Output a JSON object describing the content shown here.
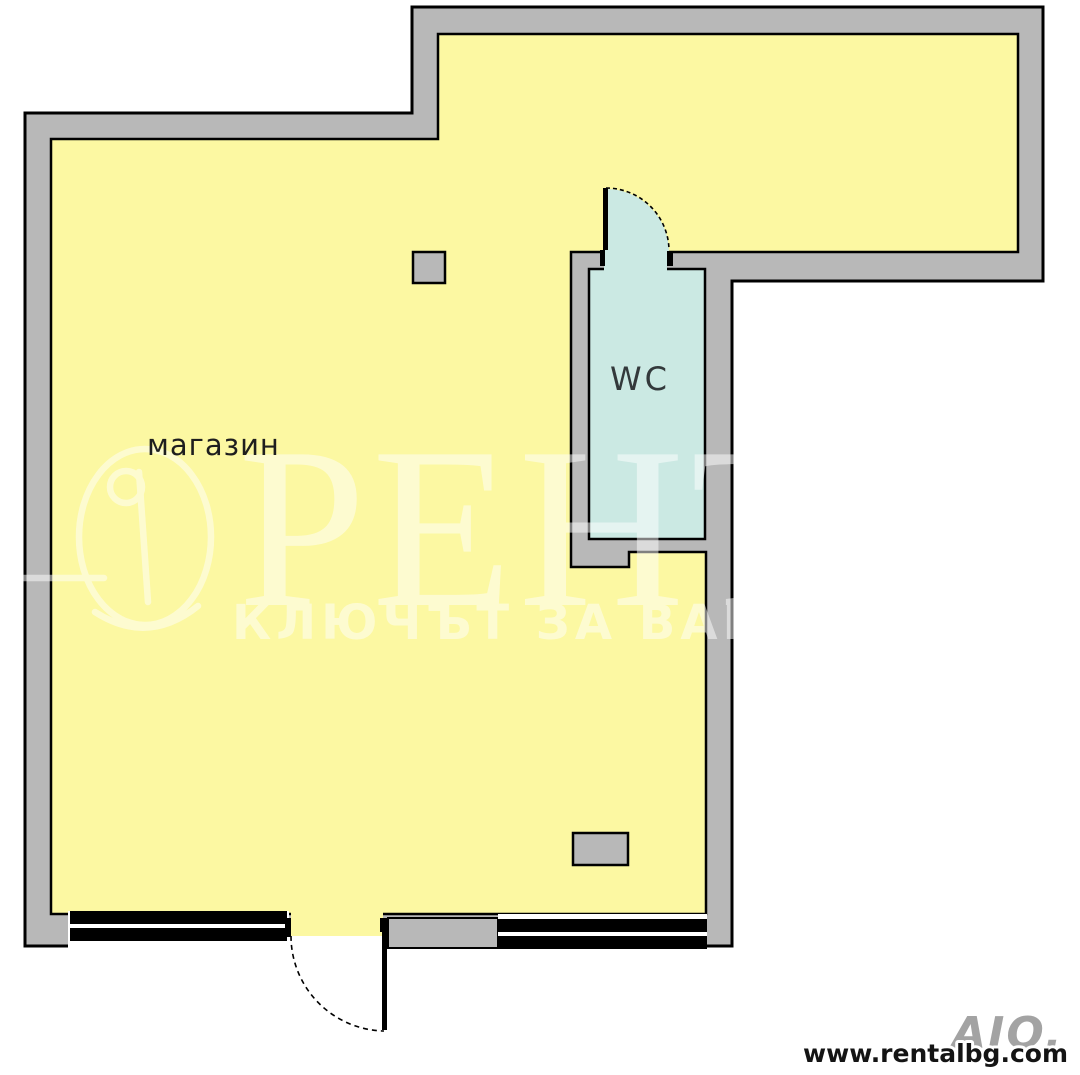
{
  "plan": {
    "shop_label": "магазин",
    "wc_label": "WC"
  },
  "watermark": {
    "brand_text": "РЕНТ",
    "slogan_text": "КЛЮЧЪТ ЗА ВАШ",
    "logo_name": "rent-circle-lamp-logo",
    "opacity": "0.5"
  },
  "footer": {
    "website_url": "www.rentalbg.com",
    "agency_watermark": "AIO."
  },
  "colors": {
    "room_fill": "#FCF8A2",
    "wc_fill": "#CBE9E3",
    "wall_fill": "#B8B8B8",
    "outline": "#000000",
    "window_bar": "#000000",
    "background": "#FFFFFF",
    "shop_label_color": "#1E1E1E",
    "wc_label_color": "#33393B",
    "website_color": "#141414",
    "agency_watermark_color": "#A3A3A3",
    "watermark_color": "#FFFFFF"
  }
}
